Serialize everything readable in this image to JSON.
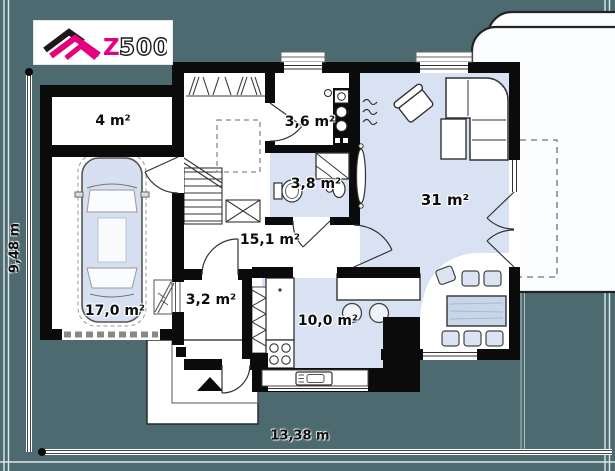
{
  "page": {
    "type": "house-floor-plan"
  },
  "logo": {
    "brand_z": "Z",
    "brand_rest": "500"
  },
  "rooms": [
    {
      "id": "storage",
      "area_label": "4 m²"
    },
    {
      "id": "garage",
      "area_label": "17,0 m²"
    },
    {
      "id": "hall",
      "area_label": "15,1 m²"
    },
    {
      "id": "utility",
      "area_label": "3,6 m²"
    },
    {
      "id": "bathroom",
      "area_label": "3,8 m²"
    },
    {
      "id": "living-room",
      "area_label": "31 m²"
    },
    {
      "id": "vestibule",
      "area_label": "3,2 m²"
    },
    {
      "id": "kitchen",
      "area_label": "10,0 m²"
    }
  ],
  "dimensions": {
    "total_width": "13,38 m",
    "total_height": "9,48 m"
  },
  "colors": {
    "background_teal": "#4C6A6F",
    "wall_black": "#0B0B0B",
    "floor_blue": "#D9E2F3",
    "floor_white": "#FFFFFF",
    "accent_magenta": "#E5007E"
  },
  "icons": [
    "car-icon",
    "sofa-icon",
    "armchair-icon",
    "coffee-table-icon",
    "dining-table-icon",
    "chair-icon",
    "bar-stool-icon",
    "stove-icon",
    "kitchen-sink-icon",
    "washer-icon",
    "boiler-icon",
    "toilet-icon",
    "shower-icon",
    "washbasin-icon",
    "radiator-icon",
    "stairs-icon",
    "entrance-arrow-icon"
  ]
}
